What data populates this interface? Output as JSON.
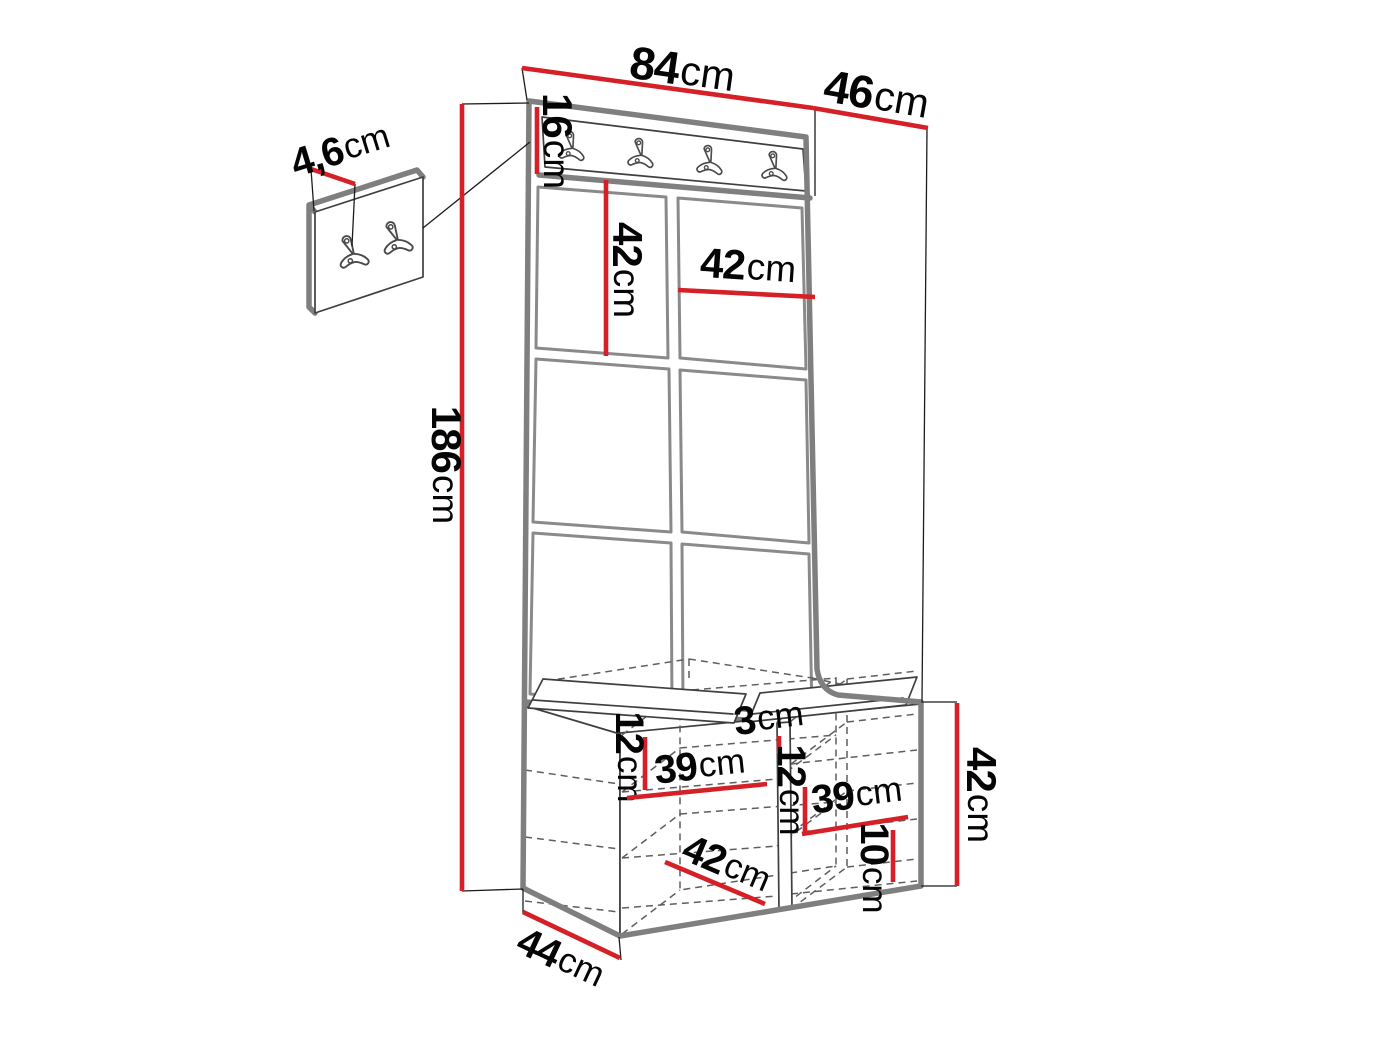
{
  "diagram": {
    "kind": "hallway-furniture-dimension-drawing",
    "accent_color": "#d42026",
    "outline_color": "#7f7f7f",
    "hook_rail_hooks": 4,
    "wall_panel_hooks": 2,
    "upholstered_panel_grid": {
      "columns": 2,
      "rows": 3
    },
    "dimensions": {
      "top_width": {
        "num": "84",
        "unit": "cm"
      },
      "side_depth": {
        "num": "46",
        "unit": "cm"
      },
      "rail_height": {
        "num": "16",
        "unit": "cm"
      },
      "panel_height": {
        "num": "42",
        "unit": "cm"
      },
      "panel_width": {
        "num": "42",
        "unit": "cm"
      },
      "total_height": {
        "num": "186",
        "unit": "cm"
      },
      "detail_thickness": {
        "num": "4,6",
        "unit": "cm"
      },
      "left_shelf_drop": {
        "num": "12",
        "unit": "cm"
      },
      "left_shelf_width": {
        "num": "39",
        "unit": "cm"
      },
      "divider_thickness": {
        "num": "3",
        "unit": "cm"
      },
      "right_shelf_drop": {
        "num": "12",
        "unit": "cm"
      },
      "right_shelf_width": {
        "num": "39",
        "unit": "cm"
      },
      "bench_inner_depth": {
        "num": "42",
        "unit": "cm"
      },
      "bottom_gap": {
        "num": "10",
        "unit": "cm"
      },
      "bench_height": {
        "num": "42",
        "unit": "cm"
      },
      "bench_depth": {
        "num": "44",
        "unit": "cm"
      }
    }
  }
}
